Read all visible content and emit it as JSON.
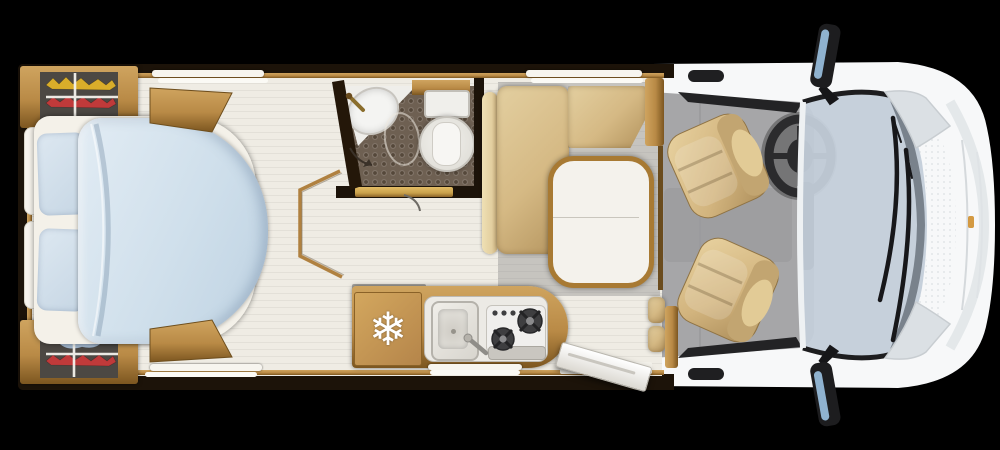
{
  "page": {
    "kind": "motorhome-floorplan-top-view",
    "orientation": "rear-left-front-right"
  },
  "icons": {
    "fridge_snowflake": "❄"
  },
  "colors": {
    "background": "#000000",
    "wall": "#1c1309",
    "floor": "#efece4",
    "floor_gray": "#c6c4bf",
    "cab_floor": "#a6a6a8",
    "wood": "#b98a46",
    "wood_light": "#cfa45f",
    "wood_dark": "#7c5620",
    "bed_duvet": "#cfdfeb",
    "bed_duvet_light": "#e2ecf4",
    "bed_pillow": "#c6d6e4",
    "bedding_white": "#f4f1e9",
    "upholstery": "#d5b984",
    "upholstery_light": "#e3cfa0",
    "upholstery_dark": "#b3935d",
    "shower_floor": "#6e6052",
    "shower_dot": "#55483a",
    "ceramic": "#f0efeb",
    "ceramic_shadow": "#c2bfb8",
    "table_top": "#f4f2ec",
    "stove_burner": "#3e3e40",
    "garage_bg": "#4c4843",
    "bike_yellow": "#d9ad2a",
    "bike_red": "#c03a3a",
    "bike_blue": "#a3b8cf",
    "glass": "#c3ced9",
    "body_white": "#f7f8f9",
    "body_shade": "#e4e8ea",
    "trim_black": "#1d1d1f",
    "marker_amber": "#cf8f2e",
    "door_gold": "#c9a14b"
  },
  "regions": {
    "rear_garage": {
      "top_items": [
        "yellow-bike",
        "red-bike",
        "mount-rails"
      ],
      "bottom_items": [
        "blue-gear",
        "red-bike",
        "mount-rails"
      ]
    },
    "bedroom": {
      "items": [
        "island-bed",
        "duvet",
        "two-pillows",
        "headboard-bolsters",
        "wardrobe-top",
        "wardrobe-bottom",
        "step-platform"
      ]
    },
    "bathroom": {
      "items": [
        "washbasin",
        "faucet",
        "shower-tray",
        "shower-outline",
        "toilet",
        "sliding-door",
        "door-handle"
      ]
    },
    "dinette": {
      "items": [
        "l-shaped-bench",
        "back-bolster",
        "pedestal-table"
      ]
    },
    "kitchen": {
      "items": [
        "refrigerator",
        "sink",
        "faucet",
        "two-burner-hob",
        "control-knobs",
        "worktop",
        "service-hatch"
      ]
    },
    "cab": {
      "items": [
        "driver-seat",
        "passenger-seat",
        "steering-wheel",
        "dashboard",
        "entry-door-open"
      ]
    },
    "vehicle_front": {
      "items": [
        "windshield",
        "two-wipers",
        "hood",
        "headlights",
        "side-mirrors",
        "bumper",
        "amber-marker"
      ]
    },
    "windows": [
      "bedroom-top",
      "dinette-top",
      "bedroom-bottom",
      "kitchen-hatch"
    ]
  }
}
